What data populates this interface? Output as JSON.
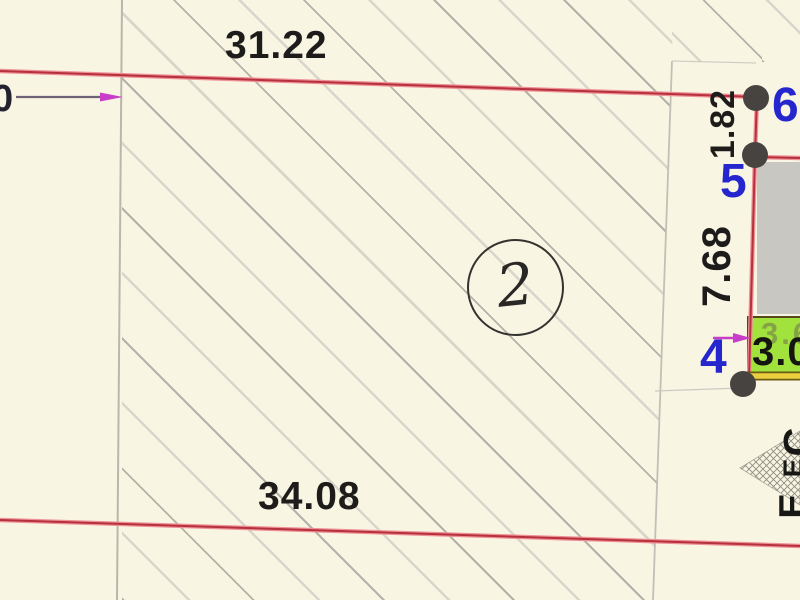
{
  "drawing": {
    "parcel_number": "2",
    "dimensions": {
      "top": "31.22",
      "bottom": "34.08",
      "right_upper": "1.82",
      "right_lower": "7.68",
      "highlight_value": "3.0",
      "highlight_ghost": "3.6"
    },
    "vertices": {
      "v4": "4",
      "v5": "5",
      "v6": "6"
    },
    "origin_label": "0",
    "edge_fragments": [
      "С",
      "Е",
      "Е"
    ],
    "colors": {
      "background": "#f9f5e3",
      "boundary_red": "#b5323d",
      "boundary_red_soft": "#ef9097",
      "hatch_dark": "#b4b1a8",
      "hatch_light": "#d8d5cb",
      "neighbor_line_gray": "#c2bfb7",
      "vertex_dot": "#474341",
      "vertex_label_blue": "#2626cf",
      "dimension_text": "#1d1c1a",
      "highlight_green": "#a2e23c",
      "highlight_border": "#55491b",
      "yellow_line": "#eccf3e",
      "building_gray": "#c9c7c2",
      "arrow_magenta": "#c93ec9"
    }
  }
}
